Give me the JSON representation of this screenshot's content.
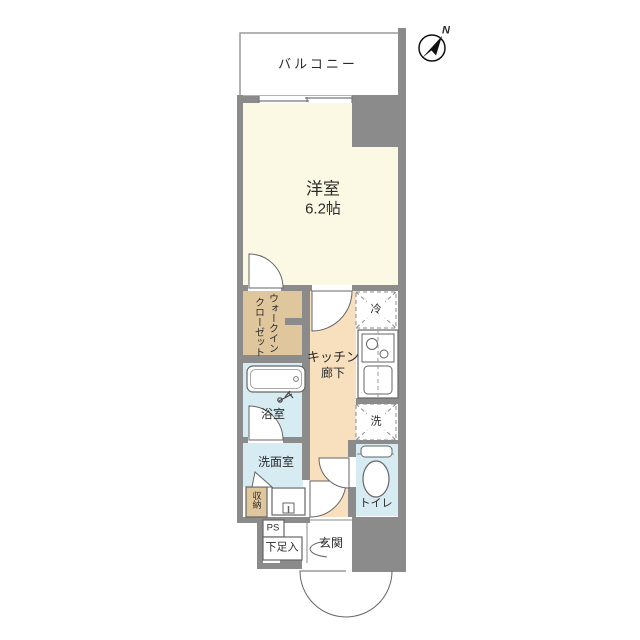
{
  "plan_title": "1K apartment floor plan",
  "palette": {
    "wall": "#8b8b8b",
    "main_room": "#fbf8e3",
    "closet": "#e0c69c",
    "kitchen": "#f8dfbe",
    "wet_area": "#d7ebf3",
    "white": "#ffffff",
    "line": "#666666",
    "text": "#2b2b2b"
  },
  "compass": {
    "north_label": "N"
  },
  "rooms": {
    "balcony": {
      "label": "バルコニー"
    },
    "main": {
      "label": "洋室",
      "size": "6.2帖"
    },
    "wic": {
      "label_line1": "ウォークイン",
      "label_line2": "クローゼット"
    },
    "kitchen": {
      "label": "キッチン",
      "sublabel": "廊下"
    },
    "bath": {
      "label": "浴室"
    },
    "washroom": {
      "label": "洗面室"
    },
    "storage": {
      "label": "収納"
    },
    "ps": {
      "label": "PS"
    },
    "shoe": {
      "label": "下足入"
    },
    "entrance": {
      "label": "玄関"
    },
    "toilet": {
      "label": "トイレ"
    }
  },
  "fixtures": {
    "refrigerator": {
      "label": "冷"
    },
    "washer": {
      "label": "洗"
    }
  }
}
